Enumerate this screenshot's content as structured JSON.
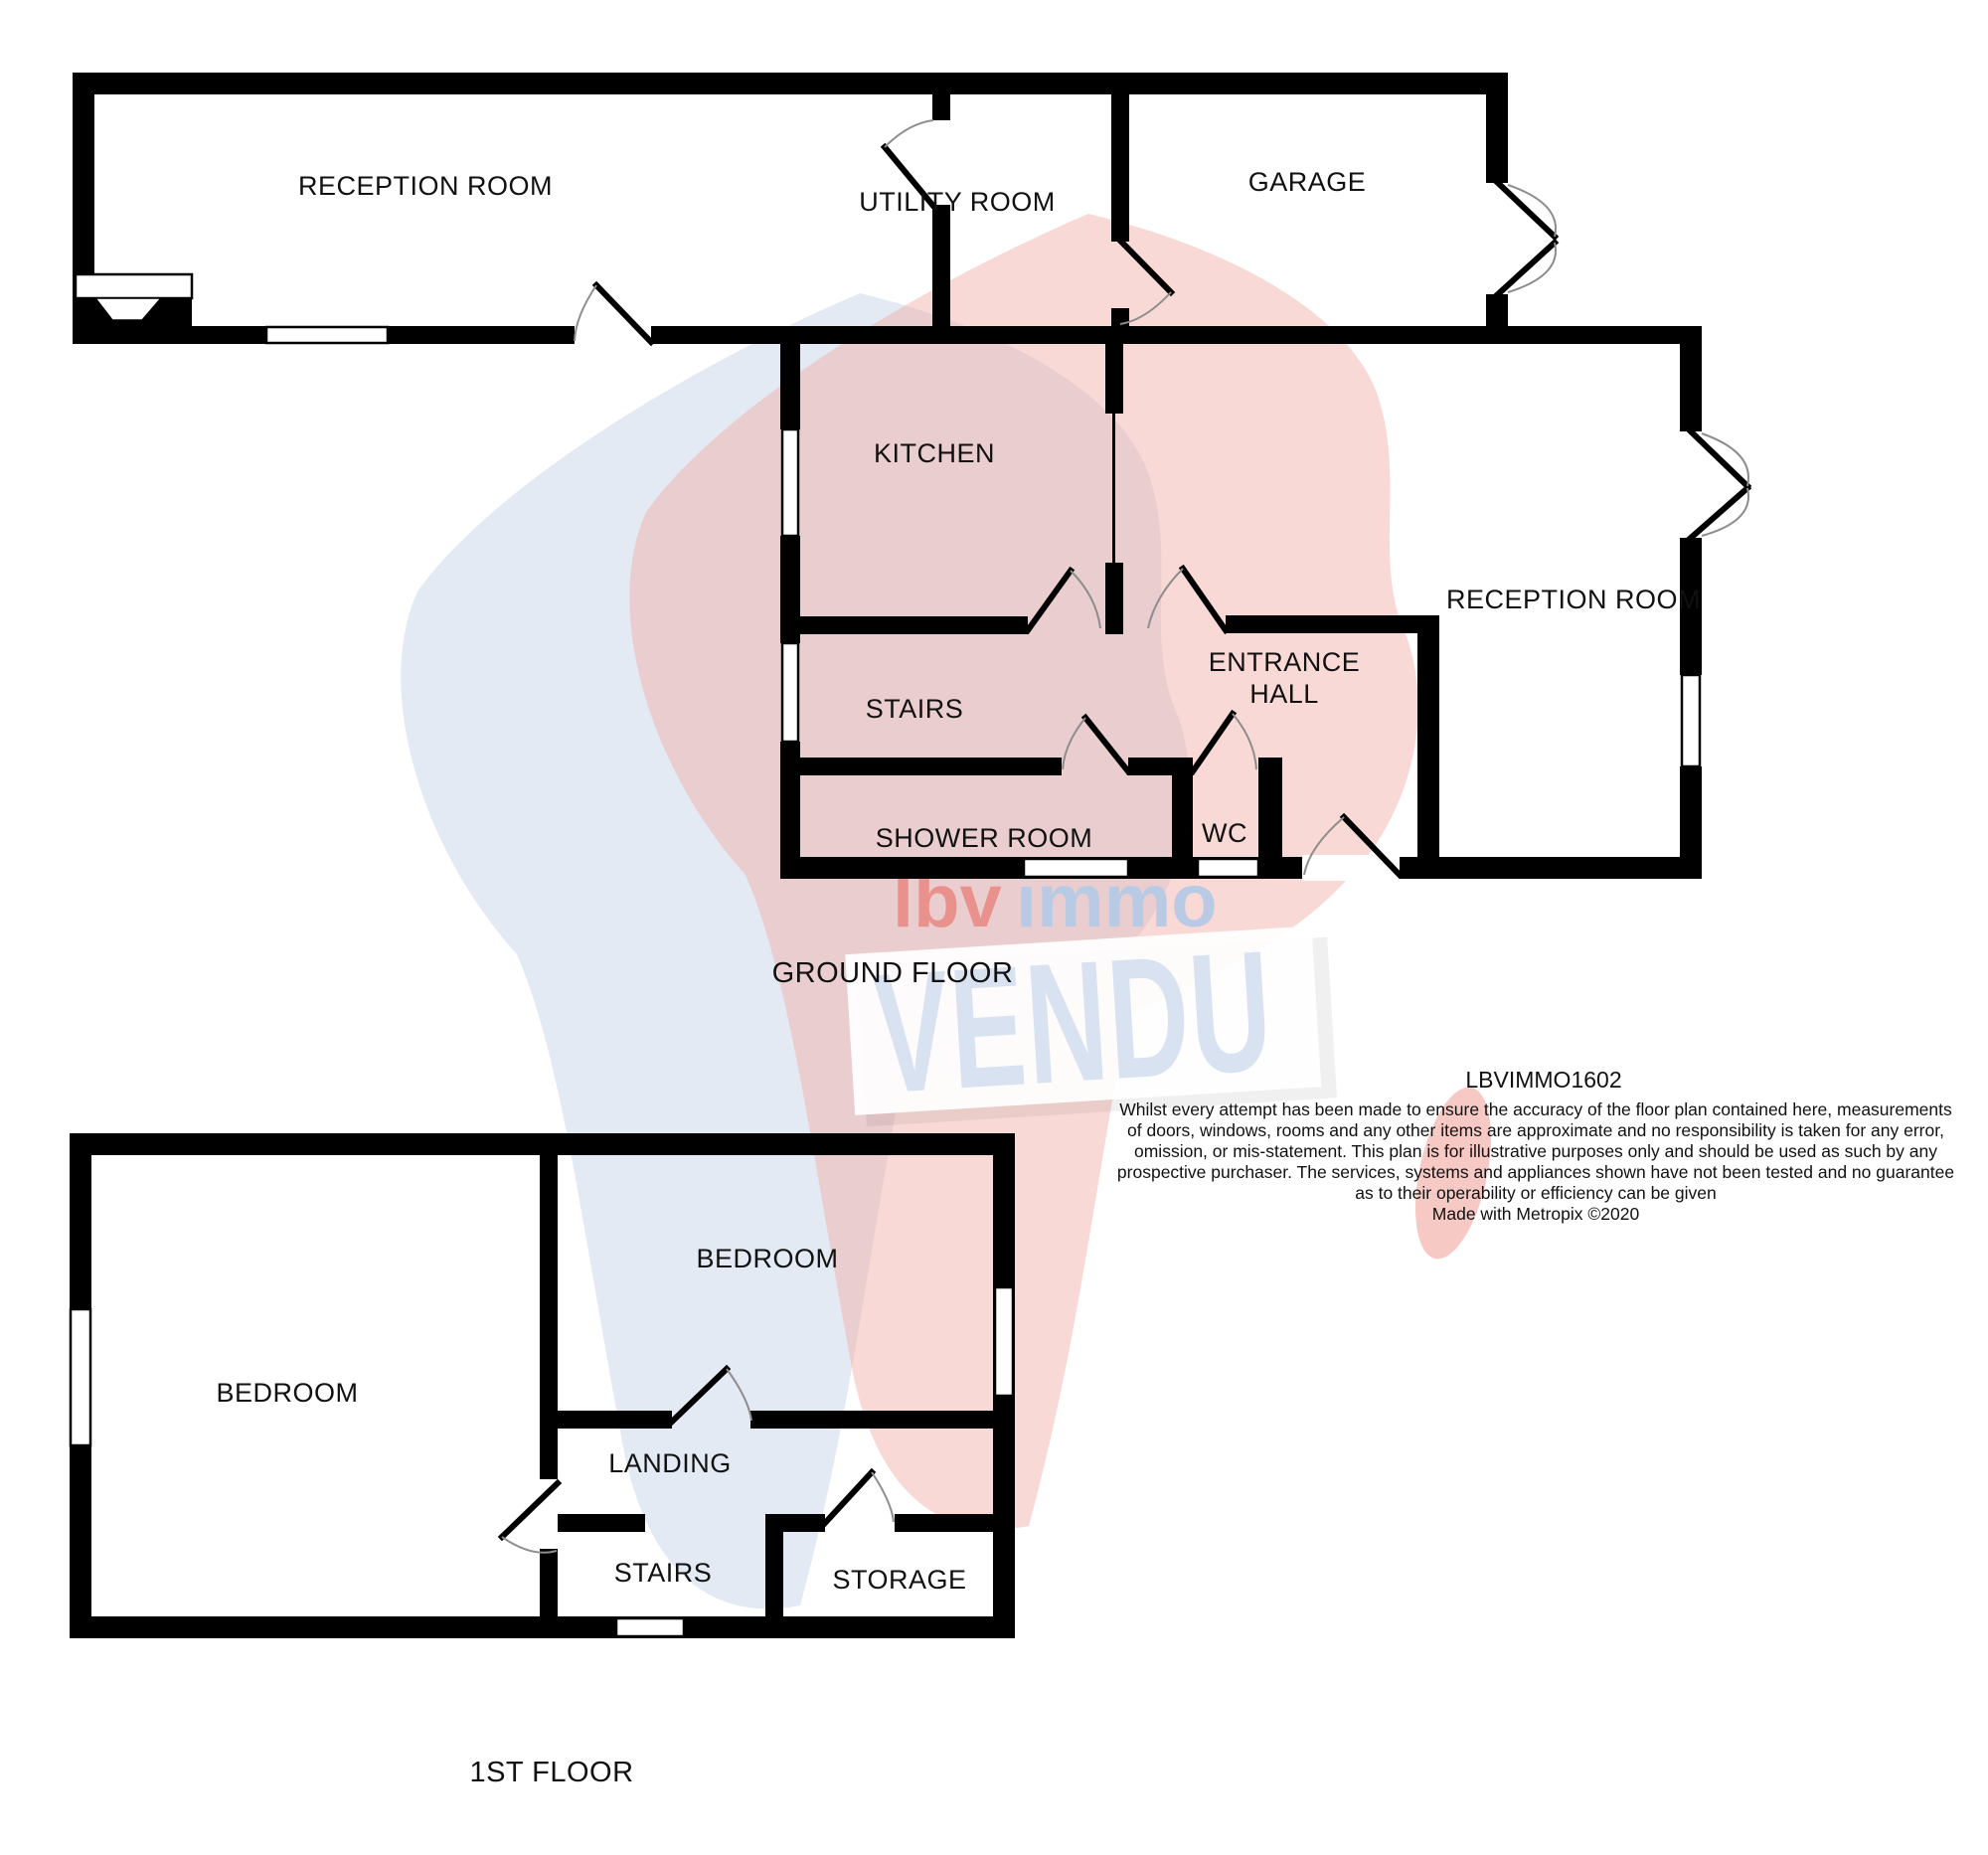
{
  "document": {
    "type": "floorplan",
    "reference": "LBVIMMO1602",
    "credit_line": "Made with Metropix ©2020"
  },
  "watermark": {
    "brand_red": "lbv",
    "brand_blue": "immo",
    "sign_text": "VENDU",
    "colors": {
      "map_blue": "#cdd9ea",
      "map_red": "#f2aba4",
      "sign_board": "#ffffff",
      "sign_letters": "#d8e2f1",
      "brand_red_color": "#e9928d",
      "brand_blue_color": "#b9cbe4"
    }
  },
  "ground_floor": {
    "title": "GROUND FLOOR",
    "rooms": {
      "reception_left": "RECEPTION ROOM",
      "utility": "UTILITY ROOM",
      "garage": "GARAGE",
      "kitchen": "KITCHEN",
      "reception_right": "RECEPTION ROOM",
      "stairs": "STAIRS",
      "entrance_hall_line1": "ENTRANCE",
      "entrance_hall_line2": "HALL",
      "shower": "SHOWER ROOM",
      "wc": "WC"
    }
  },
  "first_floor": {
    "title": "1ST FLOOR",
    "rooms": {
      "bedroom_left": "BEDROOM",
      "bedroom_right": "BEDROOM",
      "landing": "LANDING",
      "stairs": "STAIRS",
      "storage": "STORAGE"
    }
  },
  "disclaimer_lines": [
    "Whilst every attempt has been made to ensure the accuracy of the floor plan contained here, measurements",
    "of doors, windows, rooms and any other items are approximate and no responsibility is taken for any error,",
    "omission, or mis-statement. This plan is for illustrative purposes only and should be used as such by any",
    "prospective purchaser. The services, systems and appliances shown have not been tested and no guarantee",
    "as to their operability or efficiency can be given",
    "Made with Metropix ©2020"
  ]
}
